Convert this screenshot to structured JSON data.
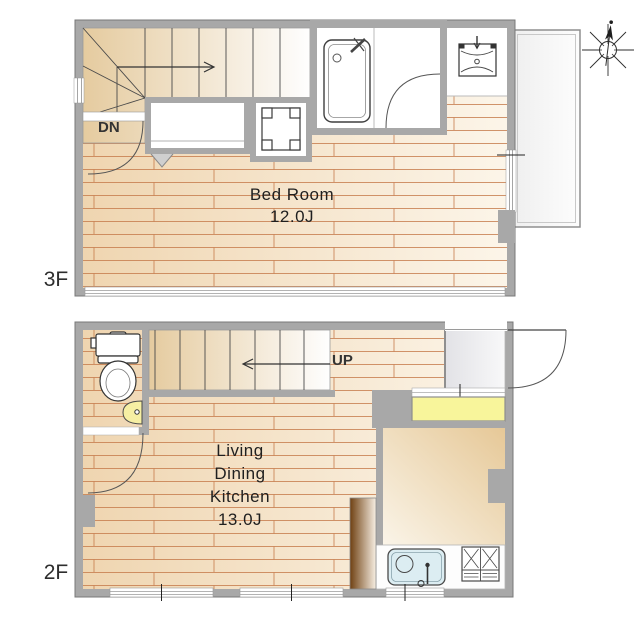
{
  "compass": {
    "icon": "north-arrow"
  },
  "floor_3f": {
    "label": "3F",
    "bedroom": {
      "name": "Bed Room",
      "size": "12.0J"
    },
    "stair_direction": "DN",
    "fixtures": [
      "staircase",
      "closet",
      "washer-pan",
      "bathtub",
      "washbasin",
      "balcony"
    ]
  },
  "floor_2f": {
    "label": "2F",
    "ldk": {
      "line1": "Living",
      "line2": "Dining",
      "line3": "Kitchen",
      "size": "13.0J"
    },
    "stair_direction": "UP",
    "fixtures": [
      "toilet",
      "corner-basin",
      "staircase",
      "entrance",
      "shoe-counter",
      "kitchen-sink",
      "gas-stove",
      "partition"
    ]
  },
  "colors": {
    "wall_gray": "#a8a8a8",
    "floor_tan": "#f0d7b3",
    "floor_light": "#fbf3e6",
    "plank_line": "#c67a4b",
    "stair_tan": "#e5cb9f",
    "counter_yellow": "#f8f59b",
    "sink_blue": "#dcedf2",
    "basin_yellow": "#f6efa3",
    "partition_brown": "#6f4012",
    "balcony_gray": "#f1f1f1"
  }
}
